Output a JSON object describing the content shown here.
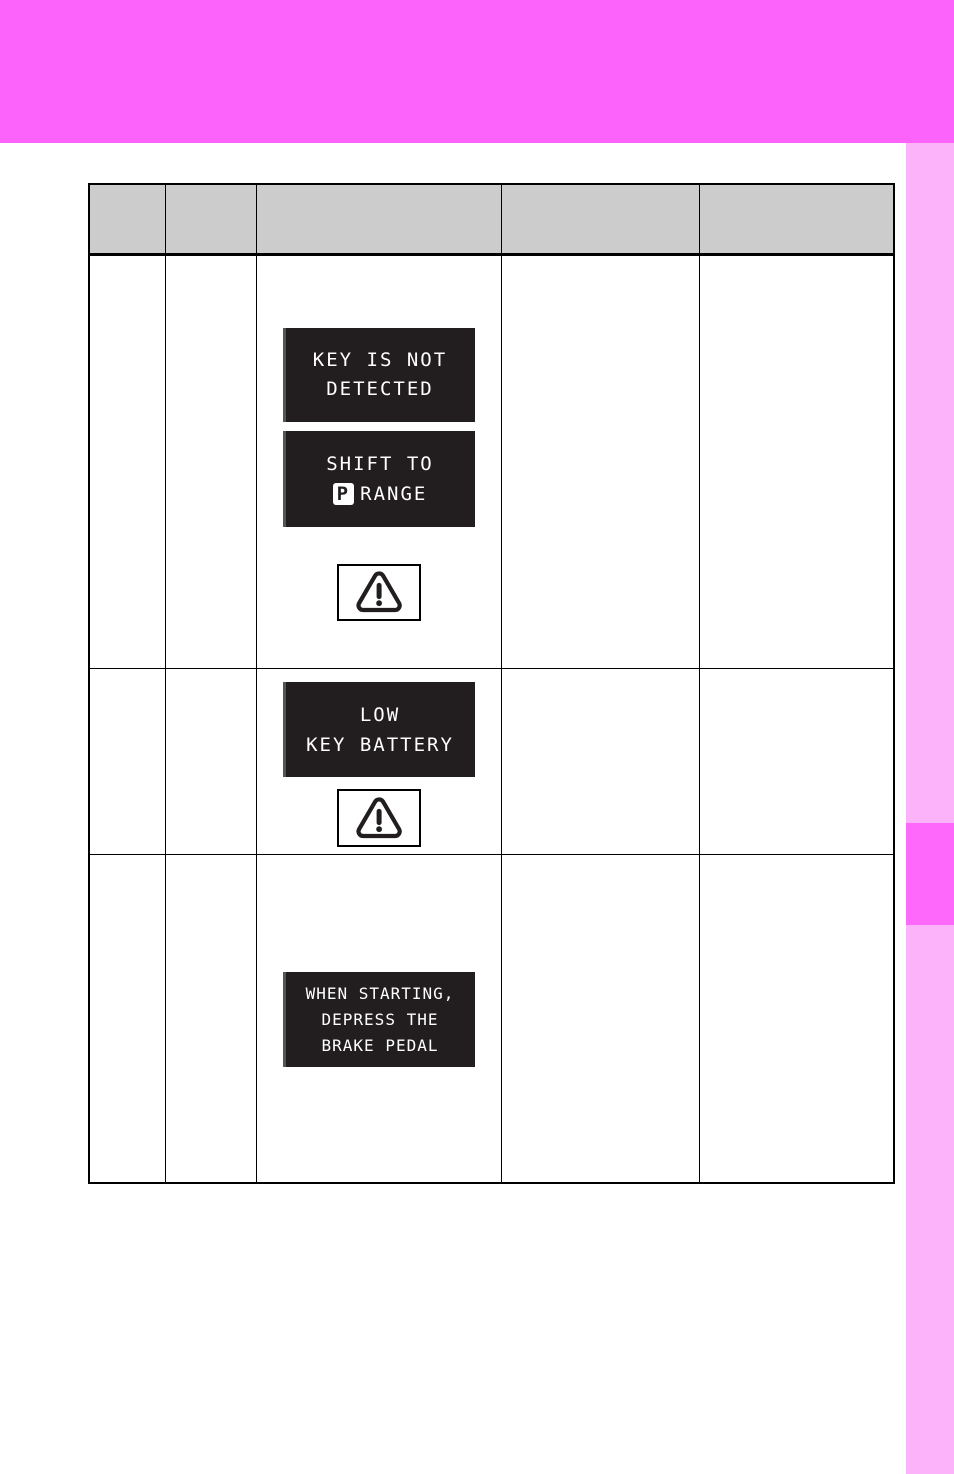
{
  "page": {
    "background": "#ffffff",
    "header_band_color": "#fb63fb",
    "side_strip_color": "#fdb3fa",
    "side_tab_color": "#fe68fb",
    "table_header_bg": "#cccccc",
    "lcd_bg": "#221e1f"
  },
  "table": {
    "headers": [
      "",
      "",
      "",
      "",
      ""
    ]
  },
  "displays": {
    "key_not_detected": {
      "line1": "KEY IS NOT",
      "line2": "DETECTED"
    },
    "shift_to_p_range": {
      "line1": "SHIFT TO",
      "p_symbol": "P",
      "line2": "RANGE"
    },
    "low_key_battery": {
      "line1": "LOW",
      "line2": "KEY BATTERY"
    },
    "when_starting": {
      "line1": "WHEN STARTING,",
      "line2": "DEPRESS THE",
      "line3": "BRAKE PEDAL"
    }
  },
  "icons": {
    "warning_triangle": "warning-triangle-icon"
  }
}
